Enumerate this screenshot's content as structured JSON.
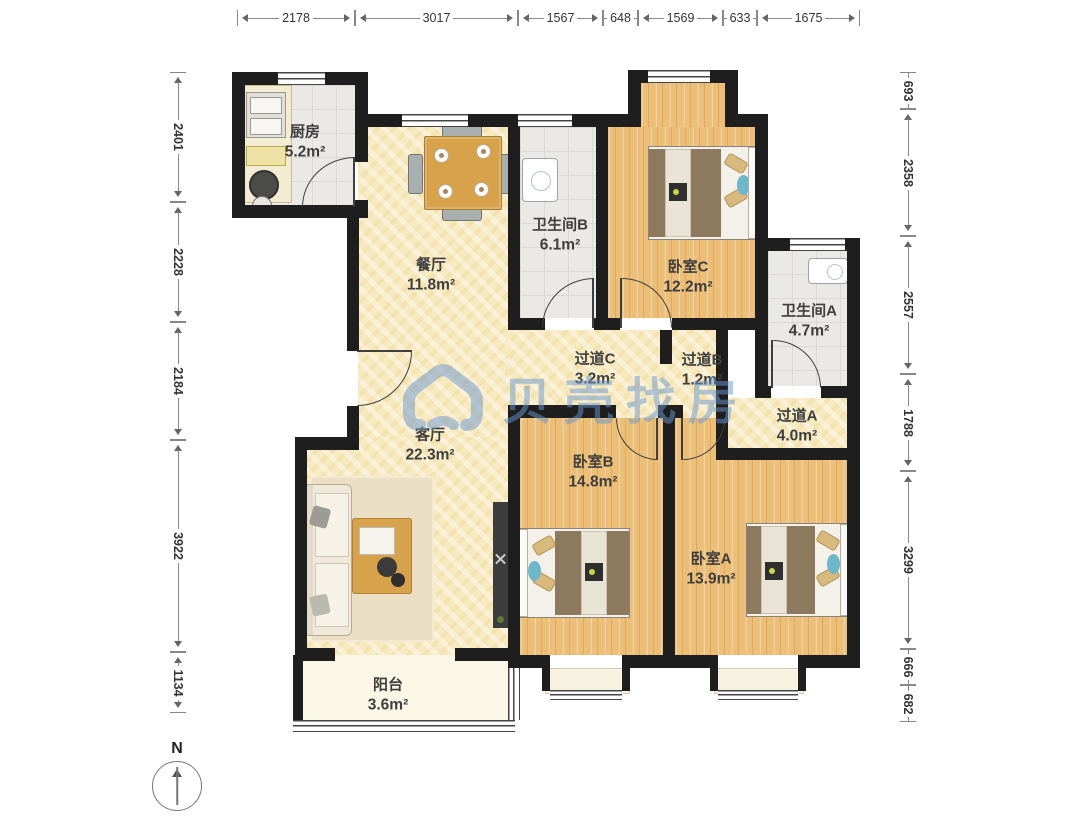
{
  "watermark": {
    "text": "贝壳找房",
    "color": "#6896d2"
  },
  "compass": {
    "label": "N"
  },
  "rooms": [
    {
      "name": "厨房",
      "area": "5.2m²"
    },
    {
      "name": "餐厅",
      "area": "11.8m²"
    },
    {
      "name": "卫生间B",
      "area": "6.1m²"
    },
    {
      "name": "卧室C",
      "area": "12.2m²"
    },
    {
      "name": "卫生间A",
      "area": "4.7m²"
    },
    {
      "name": "过道C",
      "area": "3.2m²"
    },
    {
      "name": "过道B",
      "area": "1.2m²"
    },
    {
      "name": "过道A",
      "area": "4.0m²"
    },
    {
      "name": "客厅",
      "area": "22.3m²"
    },
    {
      "name": "卧室B",
      "area": "14.8m²"
    },
    {
      "name": "卧室A",
      "area": "13.9m²"
    },
    {
      "name": "阳台",
      "area": "3.6m²"
    }
  ],
  "dimensions": {
    "top": [
      "2178",
      "3017",
      "1567",
      "648",
      "1569",
      "633",
      "1675"
    ],
    "left": [
      "2401",
      "2228",
      "2184",
      "3922",
      "1134"
    ],
    "right": [
      "693",
      "2358",
      "2557",
      "1788",
      "3299",
      "666",
      "682"
    ]
  },
  "colors": {
    "wall": "#1e1e1e",
    "wood_floor": "#ecbe76",
    "tile_floor": "#ebe9e6",
    "warm_floor": "#f7eac0",
    "balcony_floor": "#faf7e6",
    "watermark_blue": "#6896d2"
  }
}
